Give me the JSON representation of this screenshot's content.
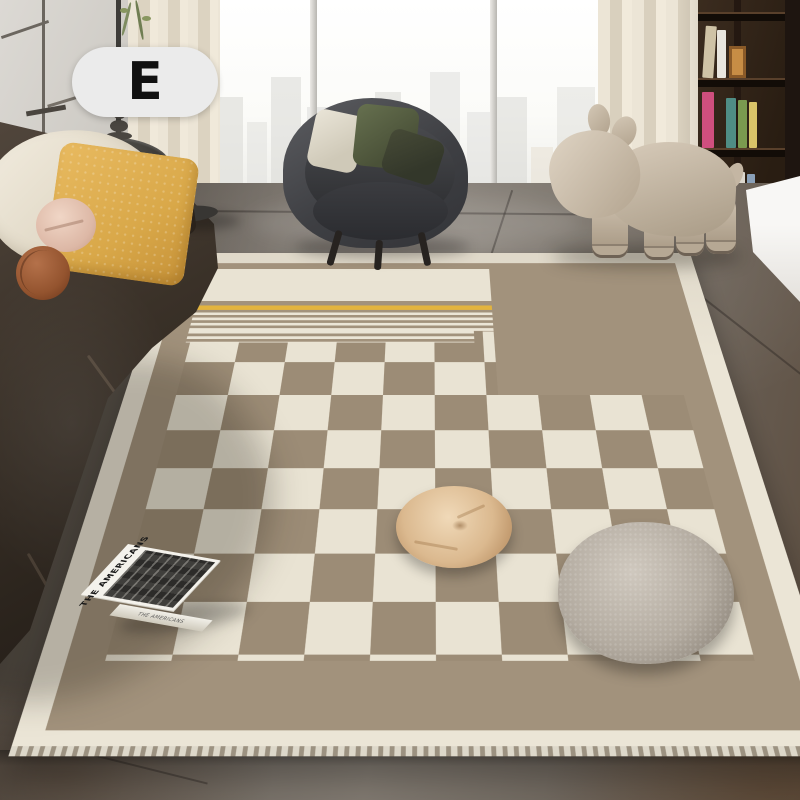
{
  "image": {
    "kind": "living-room rug product photo",
    "width": 800,
    "height": 800
  },
  "badge": {
    "label": "E"
  },
  "book": {
    "cover_title": "THE AMERICANS",
    "spine_title": "THE AMERICANS"
  },
  "objects": {
    "area_rug": {
      "style": "checkerboard with striped top band and yellow accent line",
      "border": "cream with serged edge"
    },
    "sofa": {
      "material": "dark brown leather",
      "pillows": [
        "cream",
        "yellow quilted",
        "pink round",
        "rust-brown ball"
      ]
    },
    "armchair": {
      "material": "dark gray fabric",
      "pillows": [
        "white",
        "green",
        "dark olive"
      ]
    },
    "pony_stool": {
      "material": "beige upholstered pony-shaped kids stool"
    },
    "side_table": {
      "material": "black round tray table with turned wood candle lamp"
    },
    "bookshelf": {
      "material": "dark walnut with colorful books"
    },
    "window": {
      "view": "bright city skyline",
      "mullions": 2
    },
    "curtains": {
      "material": "cream linen"
    },
    "floor": {
      "material": "gray marble tile"
    },
    "floor_cushions": [
      "beige round cushion",
      "gray boucle round cushion"
    ]
  },
  "theme": {
    "rug-cream": "#ebe5d6",
    "rug-taupe": "#a2927c",
    "rug-checker-taupe": "#9c8c76",
    "rug-checker-cream": "#e9e3d3",
    "rug-yellow": "#e3b43e",
    "badge-bg": "#ebebeb",
    "badge-text": "#111111",
    "book-white": "#f4f2ec"
  }
}
